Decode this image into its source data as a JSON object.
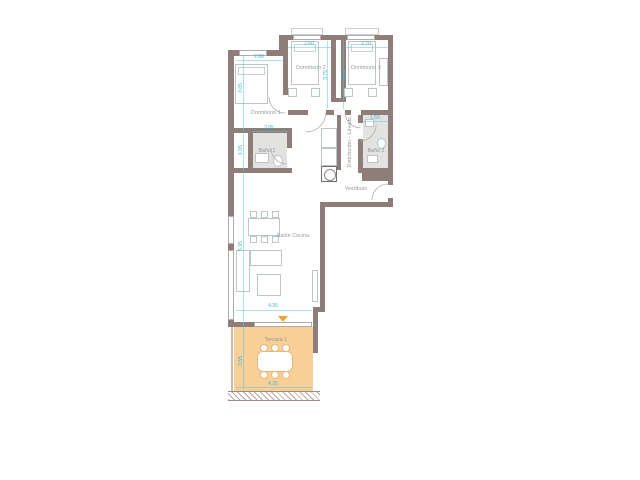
{
  "rooms": {
    "dormitorio1": "Dormitorio 1",
    "dormitorio2": "Dormitorio 2",
    "dormitorio3": "Dormitorio 3",
    "bano1": "Baño 1",
    "bano2": "Baño 2",
    "distribuidor": "Distribuidor - Lavado",
    "vestibulo": "Vestíbulo",
    "salon": "Salón Cocina",
    "terraza": "Terraza 1"
  },
  "dims": {
    "dorm1_w": "2.80",
    "dorm1_h": "3.65",
    "dorm2_w": "2.60",
    "dorm2_h": "3.75",
    "dorm3_w": "2.70",
    "dorm3_h": "3.75",
    "bano1_w": "2.05",
    "bano1_h": "1.65",
    "bano2_w": "1.55",
    "salon_w": "4.35",
    "salon_h": "5.95",
    "terraza_w": "4.25",
    "terraza_h": "3.55"
  },
  "colors": {
    "wall": "#8e7d78",
    "terrace": "#f8cf96",
    "dimension": "#3fb4c9",
    "label": "#8e9394",
    "marker": "#f0a238"
  }
}
